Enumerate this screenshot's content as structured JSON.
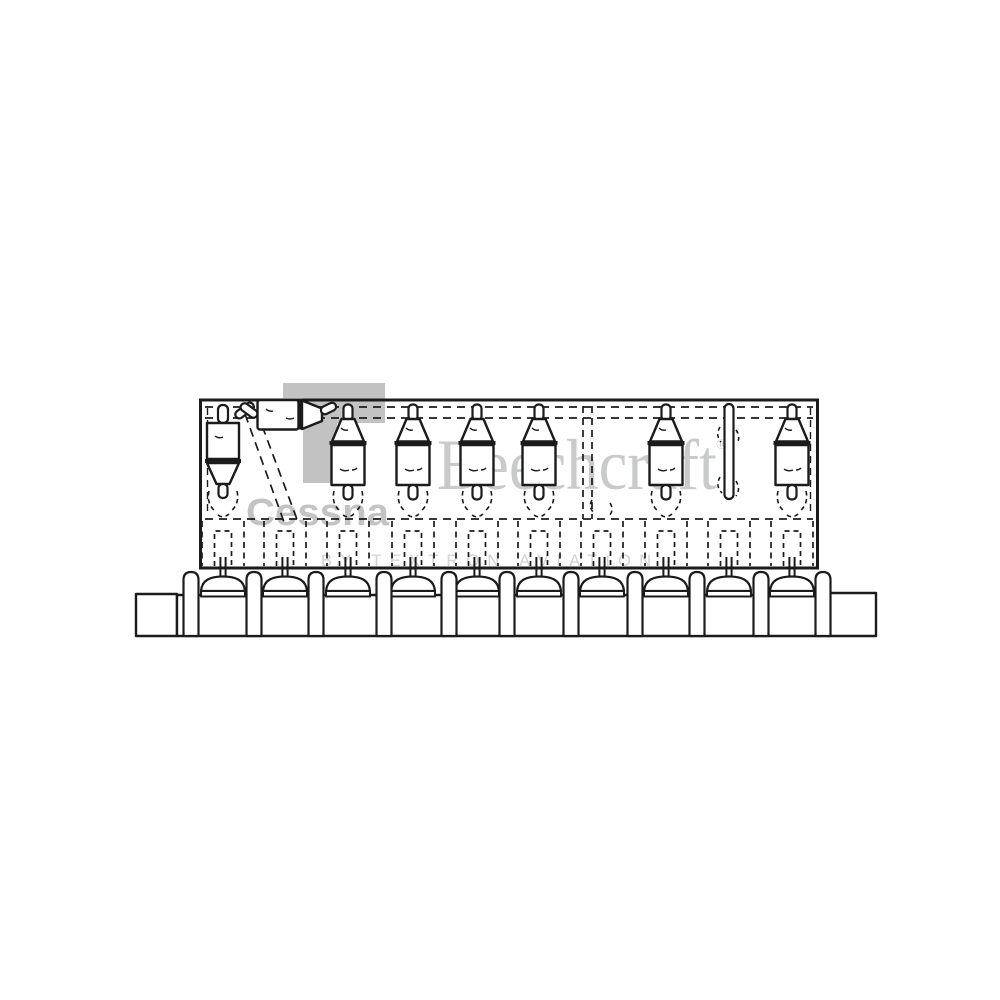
{
  "figure": {
    "description": "Scanned black-and-white parts-manual line drawing: row of poppet valves suspended above their guide bores in a cylinder bank, one valve shown rotated horizontally with dashed installation path, one bare valve stem, watermarked Cessna / Beechcraft / Textron Aviation",
    "colors": {
      "background": "#ffffff",
      "ink": "#1b1b1b",
      "watermark_logo": "#c2c2c2",
      "watermark_cessna_text": "#c3c3c3",
      "watermark_beechcraft": "#c9cbca",
      "watermark_textron": "#d2d3d3"
    },
    "watermarks": {
      "cessna_text": "Cessna",
      "beechcraft_text": "Beechcraft",
      "registered_symbol": "®",
      "textron_text": "BY TEXTRON AVIATION"
    },
    "diagram": {
      "box": {
        "x": 200.5,
        "y": 400,
        "w": 617,
        "h": 168
      },
      "bar": {
        "x": 177,
        "y": 595,
        "w": 653,
        "h": 41
      },
      "left_step": {
        "x": 136,
        "y": 594,
        "w": 41,
        "h": 42
      },
      "right_step": {
        "x": 830,
        "y": 593,
        "w": 46,
        "h": 43
      },
      "post_centers": [
        191,
        254,
        316,
        384,
        449,
        507,
        571,
        635,
        697,
        761,
        823
      ],
      "bays": [
        {
          "x": 223,
          "part": "valve-inverted"
        },
        {
          "x": 285,
          "part": "valve-removed-horizontal"
        },
        {
          "x": 348,
          "part": "valve"
        },
        {
          "x": 413,
          "part": "valve"
        },
        {
          "x": 477,
          "part": "valve"
        },
        {
          "x": 539,
          "part": "valve"
        },
        {
          "x": 602,
          "part": "none"
        },
        {
          "x": 666,
          "part": "valve"
        },
        {
          "x": 729,
          "part": "stem-only"
        },
        {
          "x": 792,
          "part": "valve"
        }
      ],
      "dash_lines_y": [
        407,
        418
      ],
      "guide_line_y": 519,
      "divider_x": [
        583,
        592
      ]
    }
  }
}
